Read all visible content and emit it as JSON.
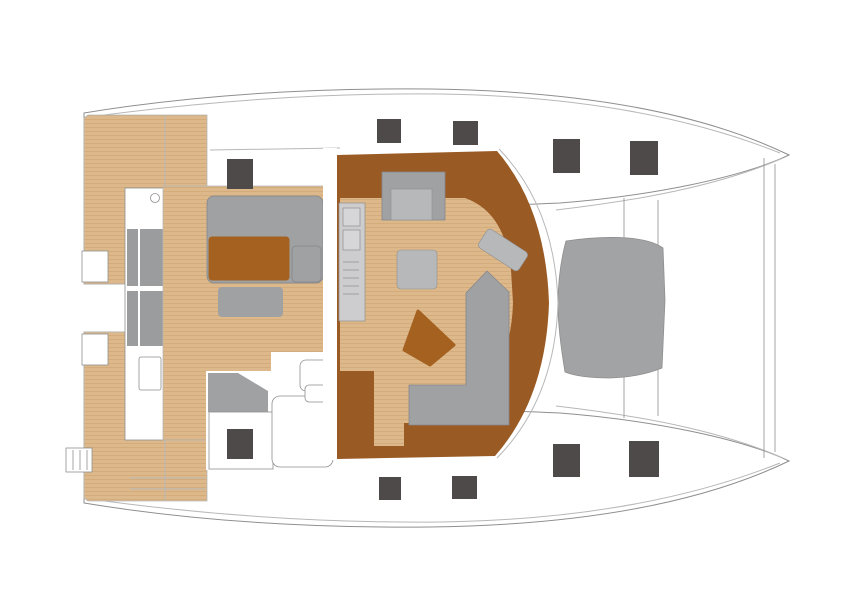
{
  "plan": {
    "type": "boat-deck-floor-plan",
    "vessel": "sailing-catamaran",
    "view": "top-down",
    "orientation": "bows-to-the-right",
    "regions": [
      "port-hull",
      "starboard-hull",
      "aft-swim-platforms",
      "boarding-ladder",
      "aft-walkway-with-steps",
      "cockpit-teak-deck",
      "cockpit-lounge-sofa",
      "cockpit-table",
      "cockpit-bench",
      "helm-seat",
      "helm-console",
      "steering-pod",
      "saloon",
      "galley-counter-with-sink-and-stove",
      "saloon-berth-seat",
      "saloon-center-table",
      "nav-chart-table",
      "nav-l-shaped-sofa",
      "triangular-cocktail-table",
      "side-decks",
      "foredeck",
      "foredeck-sunpad",
      "crossbeams",
      "forward-beam",
      "deck-hatches"
    ],
    "deck_hatch_count": 10
  },
  "colors": {
    "background": "#ffffff",
    "hull_fill": "#ffffff",
    "outline": "#8f8f8f",
    "line_light": "#b7b7b7",
    "teak": "#ddb88b",
    "teak_line": "#cba26f",
    "cabinetry_brown": "#9a5a24",
    "table_brown": "#a5611f",
    "furniture_gray": "#a0a1a3",
    "furniture_gray_light": "#b7b8ba",
    "furniture_stroke": "#85878b",
    "counter_gray": "#cdcdcf",
    "sink_gray": "#d6d6d8",
    "step_gray": "#9b9c9e",
    "pad_gray": "#a2a3a5",
    "hatch_dark": "#4e4a4a"
  }
}
